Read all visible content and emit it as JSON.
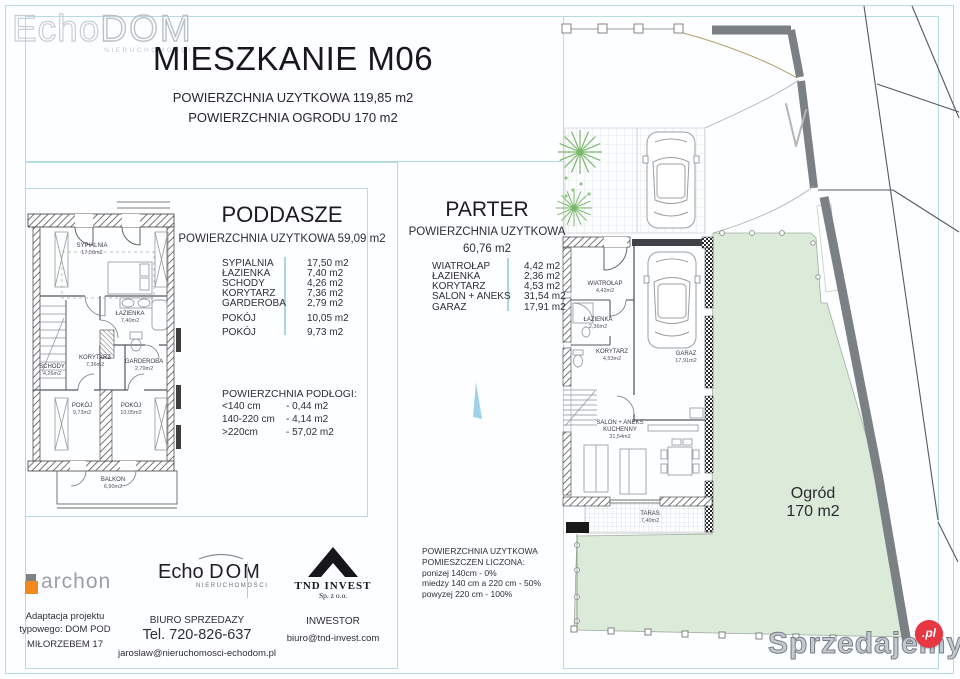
{
  "header": {
    "title": "MIESZKANIE M06",
    "subtitle1": "POWIERZCHNIA UZYTKOWA 119,85 m2",
    "subtitle2": "POWIERZCHNIA OGRODU 170 m2"
  },
  "watermark_top": {
    "echo": "Echo",
    "dom": "DOM",
    "sub": "NIERUCHOMOŚCI"
  },
  "poddasze": {
    "title": "PODDASZE",
    "subtitle": "POWIERZCHNIA UZYTKOWA 59,09 m2",
    "rooms": [
      {
        "name": "SYPIALNIA",
        "area": "17,50 m2"
      },
      {
        "name": "ŁAZIENKA",
        "area": "7,40 m2"
      },
      {
        "name": "SCHODY",
        "area": "4,26 m2"
      },
      {
        "name": "KORYTARZ",
        "area": "7,36 m2"
      },
      {
        "name": "GARDEROBA",
        "area": "2,79 m2"
      },
      {
        "name": "POKÓJ",
        "area": "10,05 m2"
      },
      {
        "name": "POKÓJ",
        "area": "9,73 m2"
      }
    ],
    "floor_title": "POWIERZCHNIA PODŁOGI:",
    "floor_rows": [
      {
        "range": "<140 cm",
        "value": "- 0,44 m2"
      },
      {
        "range": "140-220 cm",
        "value": "- 4,14 m2"
      },
      {
        "range": ">220cm",
        "value": "- 57,02 m2"
      }
    ]
  },
  "parter": {
    "title": "PARTER",
    "subtitle": "POWIERZCHNIA UZYTKOWA",
    "area": "60,76 m2",
    "rooms": [
      {
        "name": "WIATROŁAP",
        "area": "4,42 m2"
      },
      {
        "name": "ŁAZIENKA",
        "area": "2,36 m2"
      },
      {
        "name": "KORYTARZ",
        "area": "4,53 m2"
      },
      {
        "name": "SALON + ANEKS",
        "area": "31,54 m2"
      },
      {
        "name": "GARAZ",
        "area": "17,91 m2"
      }
    ],
    "note": [
      "POWIERZCHNIA UZYTKOWA",
      "POMIESZCZEN LICZONA:",
      "ponizej 140cm    - 0%",
      "miedzy 140 cm a 220 cm - 50%",
      "powyzej 220 cm - 100%"
    ]
  },
  "plan_poddasze": {
    "sypialnia": {
      "name": "SYPIALNIA",
      "area": "17,50m2"
    },
    "lazienka": {
      "name": "ŁAZIENKA",
      "area": "7,40m2"
    },
    "schody": {
      "name": "SCHODY",
      "area": "4,26m2"
    },
    "korytarz": {
      "name": "KORYTARZ",
      "area": "7,36m2"
    },
    "garderoba": {
      "name": "GARDEROBA",
      "area": "2,79m2"
    },
    "pokoj1": {
      "name": "POKÓJ",
      "area": "9,73m2"
    },
    "pokoj2": {
      "name": "POKÓJ",
      "area": "10,05m2"
    },
    "balkon": {
      "name": "BALKON",
      "area": "6,90m2"
    }
  },
  "plan_parter": {
    "wiatrolap": {
      "name": "WIATROŁAP",
      "area": "4,42m2"
    },
    "lazienka": {
      "name": "ŁAZIENKA",
      "area": "2,36m2"
    },
    "korytarz": {
      "name": "KORYTARZ",
      "area": "4,53m2"
    },
    "garaz": {
      "name": "GARAZ",
      "area": "17,91m2"
    },
    "salon1": "SALON + ANEKS",
    "salon2": "KUCHENNY",
    "salon_area": "31,54m2",
    "taras": {
      "name": "TARAS",
      "area": "7,40m2"
    },
    "ogrod1": "Ogród",
    "ogrod2": "170 m2"
  },
  "footer": {
    "archon": {
      "name": "archon",
      "line1": "Adaptacja projektu",
      "line2": "typowego: DOM POD",
      "line3": "MIŁORZEBEM 17"
    },
    "echodom": {
      "logo_echo": "Echo ",
      "logo_dom": "DOM",
      "logo_sub": "NIERUCHOMOŚCI",
      "line1": "BIURO SPRZEDAZY",
      "line2": "Tel. 720-826-637",
      "line3": "jaroslaw@nieruchomosci-echodom.pl"
    },
    "tnd": {
      "name": "TND INVEST",
      "sub": "Sp. z o.o.",
      "line1": "INWESTOR",
      "line2": "biuro@tnd-invest.com"
    }
  },
  "watermark_bottom": {
    "text": "Sprzedajemy",
    "pl": ".pl"
  },
  "colors": {
    "frame_blue": "#b7dbe4",
    "garden_green": "#dcead9",
    "wall_band_gray": "#7b8084",
    "badge_red": "#e63743",
    "archon_orange": "#f28a1e"
  }
}
